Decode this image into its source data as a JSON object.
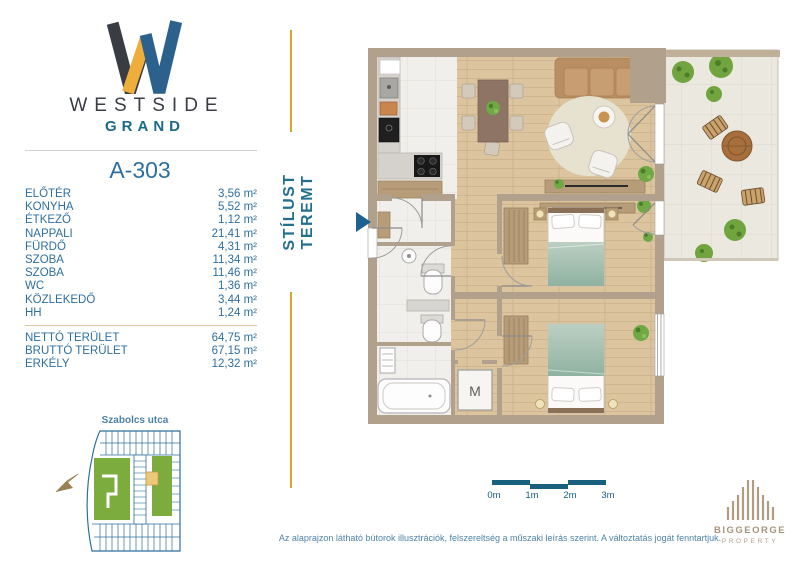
{
  "brand": {
    "line1": "WESTSIDE",
    "line2": "GRAND"
  },
  "tagline": "STÍLUST TEREMT",
  "unit": {
    "id": "A-303",
    "rooms": [
      {
        "name": "ELŐTÉR",
        "area": "3,56 m²"
      },
      {
        "name": "KONYHA",
        "area": "5,52 m²"
      },
      {
        "name": "ÉTKEZŐ",
        "area": "1,12 m²"
      },
      {
        "name": "NAPPALI",
        "area": "21,41 m²"
      },
      {
        "name": "FÜRDŐ",
        "area": "4,31 m²"
      },
      {
        "name": "SZOBA",
        "area": "11,34 m²"
      },
      {
        "name": "SZOBA",
        "area": "11,46 m²"
      },
      {
        "name": "WC",
        "area": "1,36 m²"
      },
      {
        "name": "KÖZLEKEDŐ",
        "area": "3,44 m²"
      },
      {
        "name": "HH",
        "area": "1,24 m²"
      }
    ],
    "totals": [
      {
        "name": "NETTÓ TERÜLET",
        "area": "64,75 m²"
      },
      {
        "name": "BRUTTÓ TERÜLET",
        "area": "67,15 m²"
      },
      {
        "name": "ERKÉLY",
        "area": "12,32 m²"
      }
    ]
  },
  "site_map": {
    "street": "Szabolcs utca"
  },
  "floor_plan": {
    "washing_machine_label": "M"
  },
  "scale_bar": {
    "labels": [
      "0m",
      "1m",
      "2m",
      "3m"
    ]
  },
  "disclaimer": "Az alaprajzon látható bútorok illusztrációk, felszereltség a műszaki leírás szerint. A változtatás jogát fenntartjuk.",
  "developer": {
    "name": "BIGGEORGE",
    "subtitle": "PROPERTY"
  },
  "colors": {
    "brand_dark": "#3a3e44",
    "brand_gold": "#efae3b",
    "brand_blue": "#2b618c",
    "brand_teal": "#1b6b85",
    "accent_gold": "#d6a52f",
    "text_blue": "#2f6fa0",
    "scale_teal": "#19607f",
    "wall_tan": "#b0a08c",
    "wood_floor": "#dbc49e",
    "developer_tan": "#b29c81"
  }
}
